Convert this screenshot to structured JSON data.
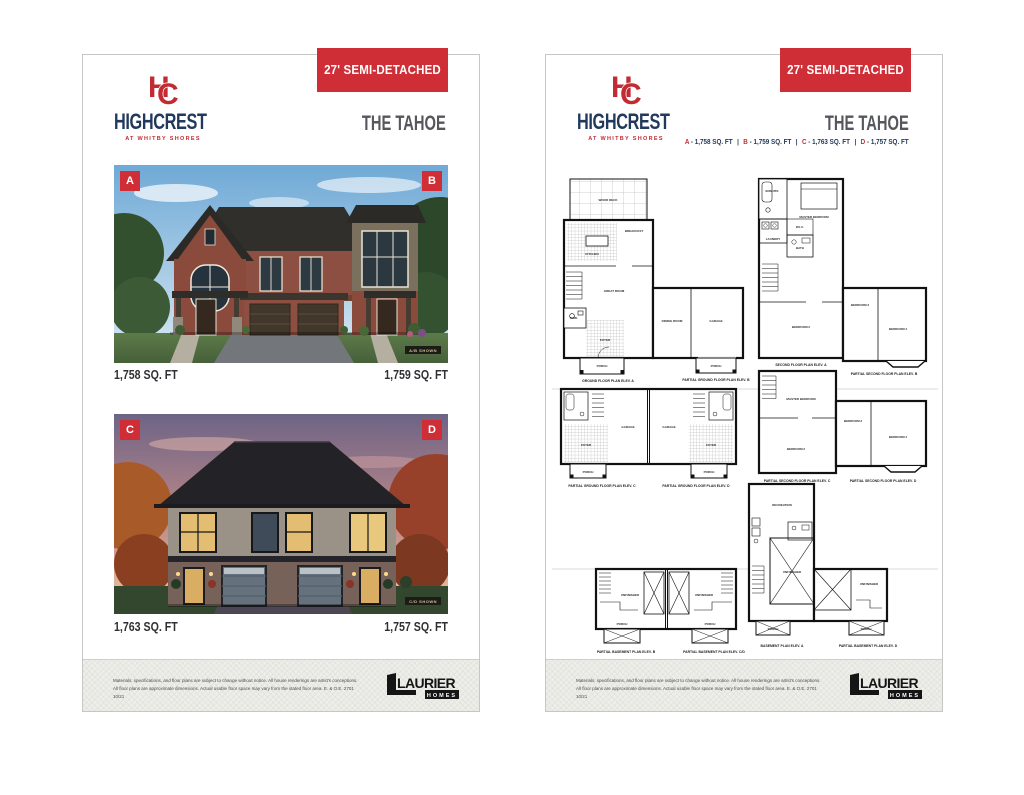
{
  "brand": {
    "monogram_h": "H",
    "monogram_c": "C",
    "name": "HIGHCREST",
    "tagline": "AT WHITBY SHORES"
  },
  "banner": {
    "label": "27' SEMI-DETACHED"
  },
  "model": {
    "name": "THE TAHOE"
  },
  "left_page": {
    "renderings": [
      {
        "badge_left": "A",
        "badge_right": "B",
        "sqft_left": "1,758 SQ. FT",
        "sqft_right": "1,759 SQ. FT",
        "shown_tag": "A/B SHOWN"
      },
      {
        "badge_left": "C",
        "badge_right": "D",
        "sqft_left": "1,763 SQ. FT",
        "sqft_right": "1,757 SQ. FT",
        "shown_tag": "C/D SHOWN"
      }
    ]
  },
  "right_page": {
    "legend_sep": " - ",
    "legend_divider": "|",
    "legend": [
      {
        "letter": "A",
        "value": "1,758 SQ. FT"
      },
      {
        "letter": "B",
        "value": "1,759 SQ. FT"
      },
      {
        "letter": "C",
        "value": "1,763 SQ. FT"
      },
      {
        "letter": "D",
        "value": "1,757 SQ. FT"
      }
    ],
    "plans": {
      "ground": {
        "caption": "GROUND FLOOR PLAN ELEV. A",
        "caption2": "PARTIAL GROUND FLOOR PLAN ELEV. B",
        "rooms": {
          "deck": "WOOD DECK",
          "breakfast": "BREAKFAST",
          "kitchen": "KITCHEN",
          "great": "GREAT ROOM",
          "powder": "PWD.",
          "foyer": "FOYER",
          "porch": "PORCH",
          "dining": "DINING ROOM",
          "garage": "GARAGE",
          "porch2": "PORCH"
        }
      },
      "second": {
        "caption": "SECOND FLOOR PLAN ELEV. A",
        "caption2": "PARTIAL SECOND FLOOR PLAN ELEV. B",
        "rooms": {
          "master": "MASTER BEDROOM",
          "ensuite": "ENSUITE",
          "wic": "W.I.C.",
          "laundry": "LAUNDRY",
          "bath": "BATH",
          "bed2": "BEDROOM 2",
          "bed3": "BEDROOM 3",
          "bed4": "BEDROOM 4"
        }
      },
      "partial_ground": {
        "caption_left": "PARTIAL GROUND FLOOR PLAN ELEV. C",
        "caption_right": "PARTIAL GROUND FLOOR PLAN ELEV. D",
        "rooms": {
          "garage_left": "GARAGE",
          "garage_right": "GARAGE",
          "foyer_left": "FOYER",
          "foyer_right": "FOYER",
          "porch_left": "PORCH",
          "porch_right": "PORCH"
        }
      },
      "partial_second": {
        "caption_left": "PARTIAL SECOND FLOOR PLAN ELEV. C",
        "caption_right": "PARTIAL SECOND FLOOR PLAN ELEV. D",
        "rooms": {
          "master": "MASTER BEDROOM",
          "bed2": "BEDROOM 2",
          "bed3": "BEDROOM 3",
          "bed4": "BEDROOM 4"
        }
      },
      "basement_partial": {
        "caption_left": "PARTIAL BASEMENT PLAN ELEV. B",
        "caption_right": "PARTIAL BASEMENT PLAN ELEV. C/D",
        "rooms": {
          "unf_left": "UNFINISHED",
          "unf_right": "UNFINISHED",
          "porch_left": "PORCH",
          "porch_right": "PORCH"
        }
      },
      "basement": {
        "caption_left": "BASEMENT PLAN ELEV. A",
        "caption_right": "PARTIAL BASEMENT PLAN ELEV. D",
        "rooms": {
          "rec": "RECREATION",
          "unf": "UNFINISHED",
          "unf2": "UNFINISHED",
          "porch": "PORCH",
          "porch2": "PORCH"
        }
      }
    }
  },
  "footer": {
    "disclaimer_line1": "Materials, specifications, and floor plans are subject to change without notice. All house renderings are artist's conceptions.",
    "disclaimer_line2": "All floor plans are approximate dimensions. Actual usable floor space may vary from the stated floor area. E. & O.E. 2701 10/21",
    "logo": {
      "name": "LAURIER",
      "sub": "HOMES"
    }
  },
  "colors": {
    "accent_red": "#cf2e36",
    "navy": "#21395d",
    "title_gray": "#55575c"
  }
}
